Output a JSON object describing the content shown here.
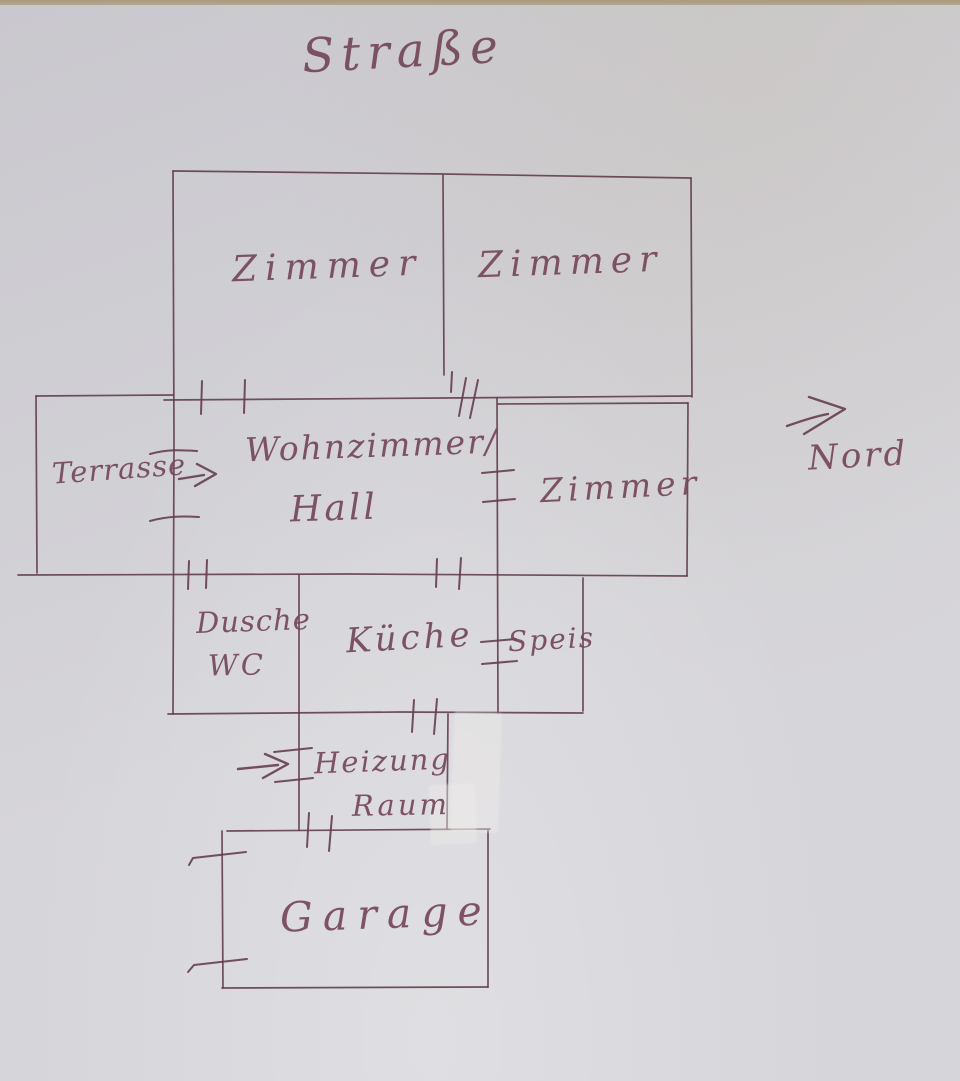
{
  "drawing": {
    "kind": "hand-drawn floor plan sketch",
    "ink_color": "#6a4254",
    "paper_color": "#d3d2d7"
  },
  "annotations": {
    "street_label": "Straße",
    "north_label": "Nord",
    "north_arrow_icon": "right-arrow"
  },
  "plan": {
    "rooms": {
      "zimmer_nw": {
        "label": "Zimmer"
      },
      "zimmer_ne": {
        "label": "Zimmer"
      },
      "terrasse": {
        "label": "Terrasse"
      },
      "wohnzimmer": {
        "line1": "Wohnzimmer/",
        "line2": "Hall"
      },
      "zimmer_e": {
        "label": "Zimmer"
      },
      "dusche": {
        "line1": "Dusche",
        "line2": "WC"
      },
      "kueche": {
        "label": "Küche"
      },
      "speis": {
        "label": "Speis"
      },
      "heizung": {
        "line1": "Heizung",
        "line2": "Raum"
      },
      "garage": {
        "label": "Garage"
      }
    },
    "entrance_arrows": [
      {
        "icon": "right-arrow",
        "at": "Terrasse wall"
      },
      {
        "icon": "right-arrow",
        "at": "Heizung Raum wall"
      }
    ]
  }
}
